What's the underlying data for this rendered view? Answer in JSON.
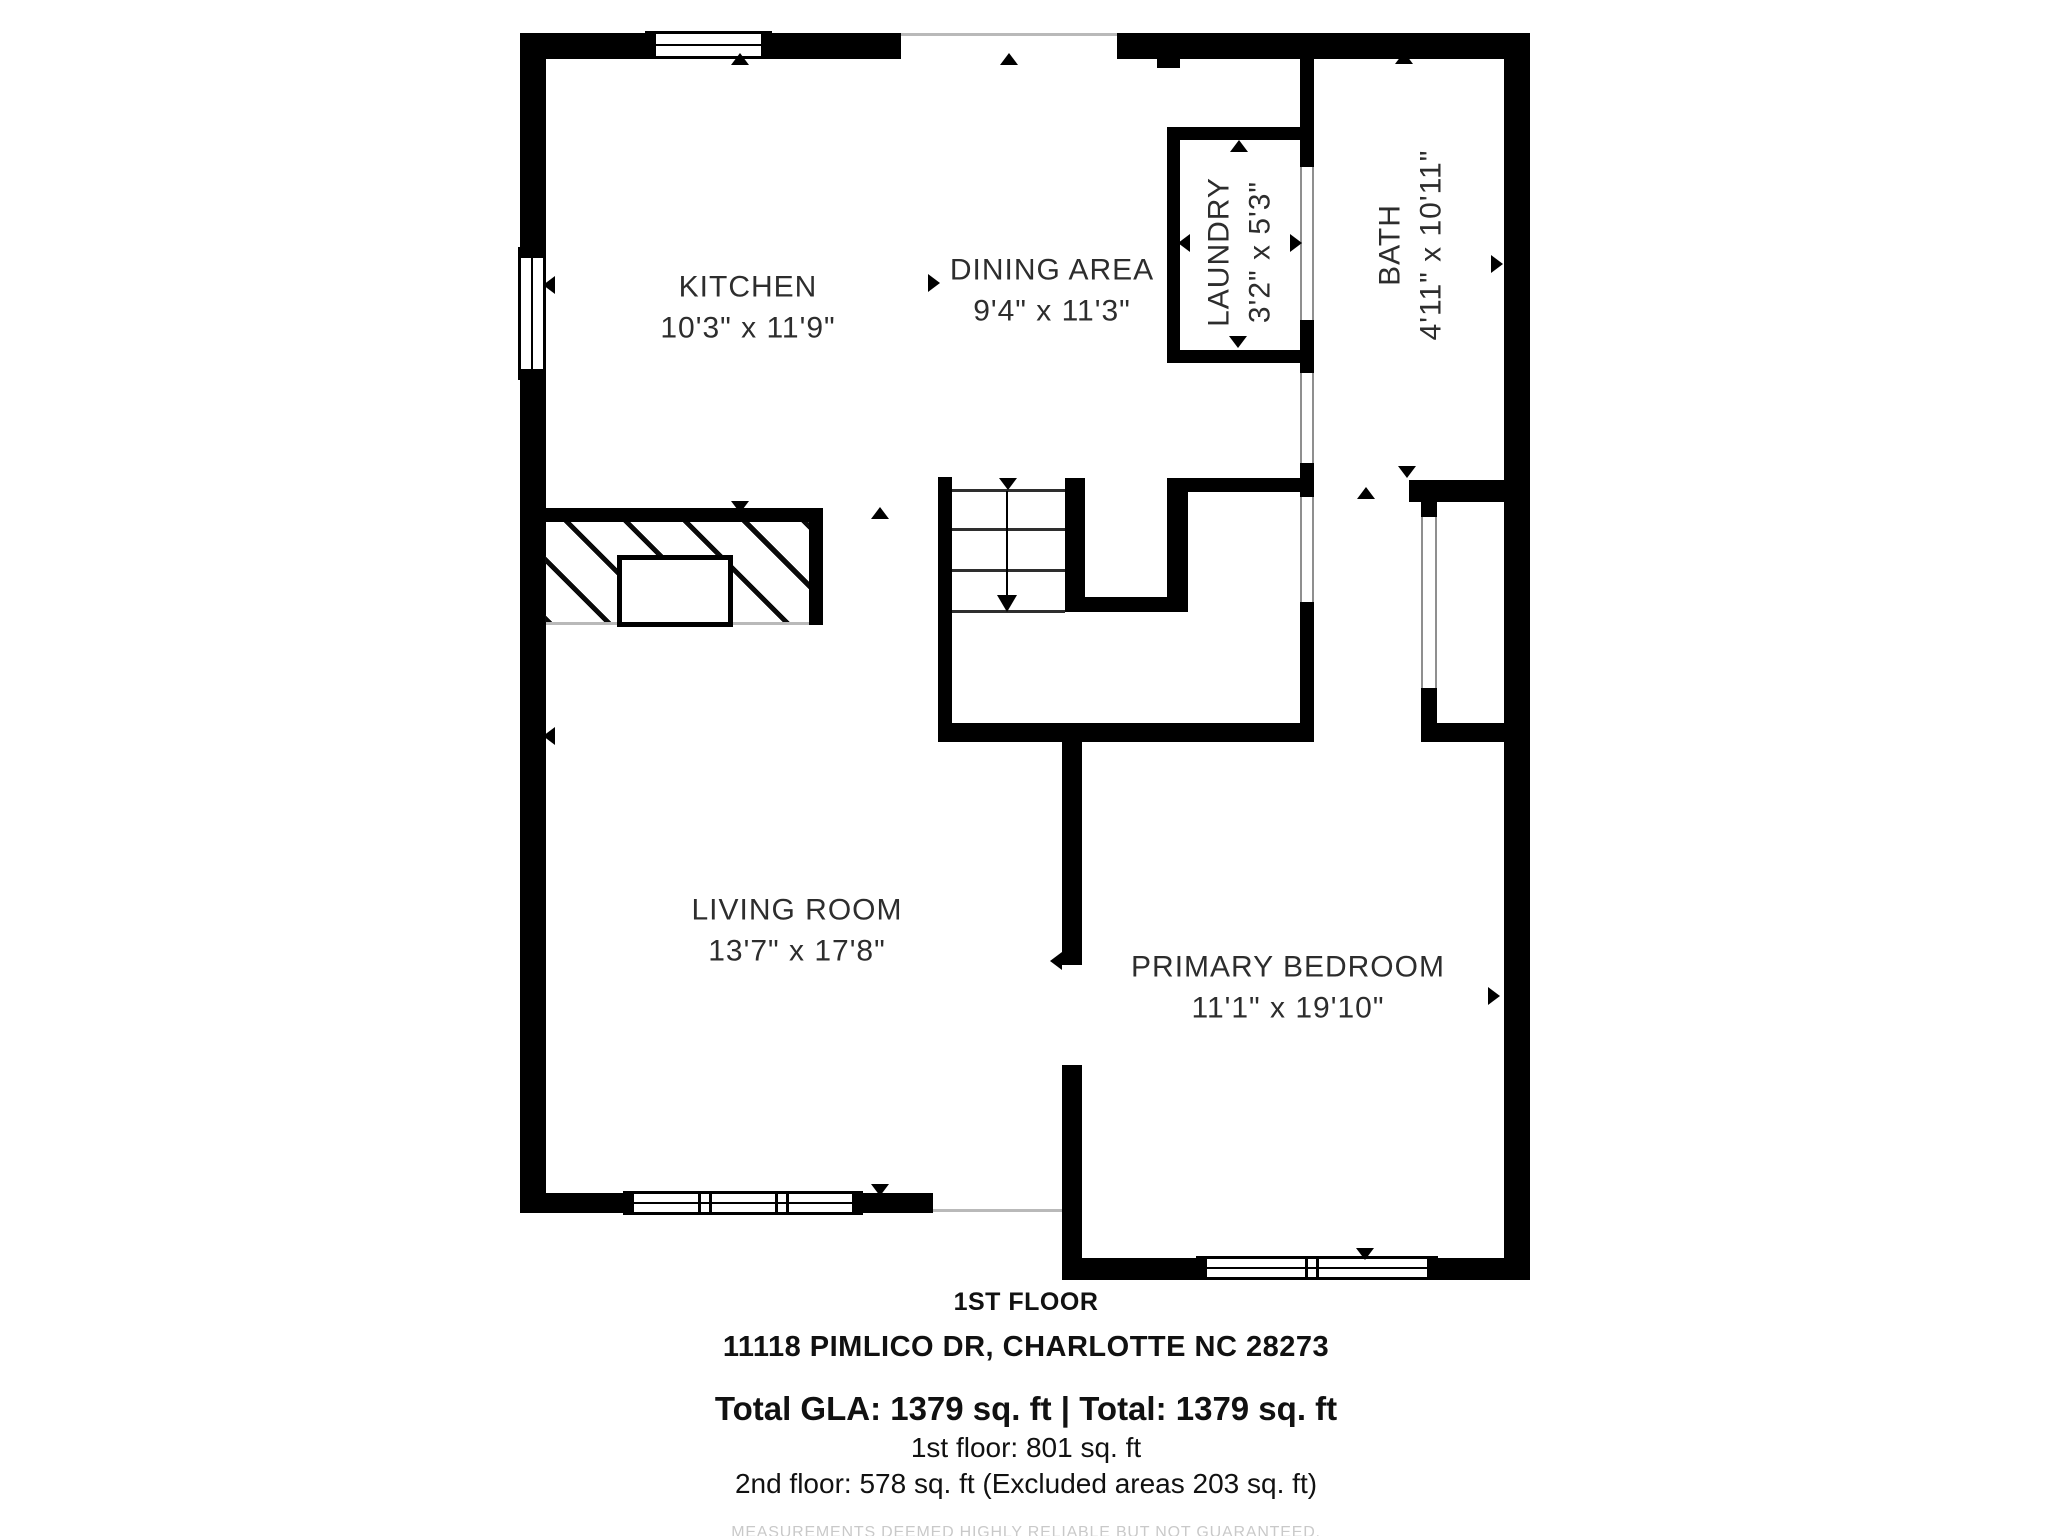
{
  "title": "1st floor plan - 11118 Pimlico Dr",
  "colors": {
    "wall": "#000000",
    "open_line": "#b9b9b9",
    "label_text": "#2d2d2d",
    "disclaimer_text": "#c9c9c9",
    "background": "#ffffff"
  },
  "rooms": [
    {
      "id": "kitchen",
      "name": "KITCHEN",
      "dims": "10'3\" x 11'9\"",
      "cx": 748,
      "cy": 308,
      "rotated": false
    },
    {
      "id": "dining-area",
      "name": "DINING AREA",
      "dims": "9'4\" x 11'3\"",
      "cx": 1052,
      "cy": 291,
      "rotated": false
    },
    {
      "id": "laundry",
      "name": "LAUNDRY",
      "dims": "3'2\" x 5'3\"",
      "cx": 1240,
      "cy": 252,
      "rotated": true
    },
    {
      "id": "bath",
      "name": "BATH",
      "dims": "4'11\" x 10'11\"",
      "cx": 1411,
      "cy": 245,
      "rotated": true
    },
    {
      "id": "living-room",
      "name": "LIVING ROOM",
      "dims": "13'7\" x 17'8\"",
      "cx": 797,
      "cy": 931,
      "rotated": false
    },
    {
      "id": "primary-bedroom",
      "name": "PRIMARY BEDROOM",
      "dims": "11'1\" x 19'10\"",
      "cx": 1288,
      "cy": 988,
      "rotated": false
    }
  ],
  "footer": {
    "floor_label": "1ST FLOOR",
    "address": "11118 PIMLICO DR, CHARLOTTE NC 28273",
    "total_line": "Total GLA: 1379 sq. ft | Total: 1379 sq. ft",
    "first_floor_line": "1st floor: 801 sq. ft",
    "second_floor_line": "2nd floor: 578 sq. ft (Excluded areas 203 sq. ft)",
    "disclaimer": "MEASUREMENTS DEEMED HIGHLY RELIABLE BUT NOT GUARANTEED."
  },
  "plan": {
    "walls": [
      {
        "n": "top-wall-left",
        "x": 520,
        "y": 33,
        "w": 125,
        "h": 26
      },
      {
        "n": "top-wall-mid",
        "x": 772,
        "y": 33,
        "w": 129,
        "h": 26
      },
      {
        "n": "top-wall-right",
        "x": 1117,
        "y": 33,
        "w": 413,
        "h": 26
      },
      {
        "n": "left-wall-upper",
        "x": 520,
        "y": 33,
        "w": 26,
        "h": 214
      },
      {
        "n": "left-wall-lower",
        "x": 520,
        "y": 375,
        "w": 26,
        "h": 838
      },
      {
        "n": "right-wall",
        "x": 1504,
        "y": 33,
        "w": 26,
        "h": 1247
      },
      {
        "n": "living-bottom-wall-left",
        "x": 520,
        "y": 1193,
        "w": 103,
        "h": 20
      },
      {
        "n": "living-bottom-wall-right",
        "x": 863,
        "y": 1193,
        "w": 70,
        "h": 20
      },
      {
        "n": "bedroom-left-wall-upper",
        "x": 1062,
        "y": 742,
        "w": 20,
        "h": 223
      },
      {
        "n": "bedroom-left-wall-lower",
        "x": 1062,
        "y": 1065,
        "w": 20,
        "h": 215
      },
      {
        "n": "bedroom-bottom-wall-left",
        "x": 1082,
        "y": 1258,
        "w": 114,
        "h": 22
      },
      {
        "n": "bedroom-bottom-wall-right",
        "x": 1438,
        "y": 1258,
        "w": 66,
        "h": 22
      },
      {
        "n": "fireplace-wall",
        "x": 545,
        "y": 508,
        "w": 278,
        "h": 14
      },
      {
        "n": "fireplace-right-wall",
        "x": 809,
        "y": 522,
        "w": 14,
        "h": 103
      },
      {
        "n": "stairwell-left-wall",
        "x": 938,
        "y": 477,
        "w": 14,
        "h": 265
      },
      {
        "n": "stair-closet-left-wall",
        "x": 1065,
        "y": 478,
        "w": 20,
        "h": 134
      },
      {
        "n": "stair-closet-right-wall",
        "x": 1167,
        "y": 478,
        "w": 21,
        "h": 134
      },
      {
        "n": "stair-closet-bottom-wall",
        "x": 1065,
        "y": 597,
        "w": 123,
        "h": 15
      },
      {
        "n": "hall-bottom-wall",
        "x": 938,
        "y": 723,
        "w": 376,
        "h": 19
      },
      {
        "n": "bedroom-top-wall-right",
        "x": 1421,
        "y": 723,
        "w": 83,
        "h": 19
      },
      {
        "n": "laundry-top-wall",
        "x": 1167,
        "y": 127,
        "w": 146,
        "h": 13
      },
      {
        "n": "laundry-bottom-wall",
        "x": 1167,
        "y": 350,
        "w": 146,
        "h": 13
      },
      {
        "n": "laundry-left-wall",
        "x": 1167,
        "y": 127,
        "w": 13,
        "h": 236
      },
      {
        "n": "bath-left-wall-upper",
        "x": 1300,
        "y": 59,
        "w": 14,
        "h": 108
      },
      {
        "n": "bath-left-wall-mid",
        "x": 1300,
        "y": 320,
        "w": 14,
        "h": 53
      },
      {
        "n": "hall-divider-nub",
        "x": 1300,
        "y": 463,
        "w": 14,
        "h": 34
      },
      {
        "n": "hall-divider-lower",
        "x": 1300,
        "y": 602,
        "w": 14,
        "h": 121
      },
      {
        "n": "bath-bottom-wall",
        "x": 1167,
        "y": 478,
        "w": 133,
        "h": 14
      },
      {
        "n": "closet-top-wall",
        "x": 1409,
        "y": 480,
        "w": 95,
        "h": 22
      },
      {
        "n": "closet-door-top-cap",
        "x": 1421,
        "y": 480,
        "w": 16,
        "h": 37
      },
      {
        "n": "closet-door-bottom-cap",
        "x": 1421,
        "y": 688,
        "w": 16,
        "h": 35
      },
      {
        "n": "top-wall-stub",
        "x": 1157,
        "y": 59,
        "w": 23,
        "h": 9
      }
    ],
    "open_lines": [
      {
        "n": "top-opening-line",
        "x": 901,
        "y": 33,
        "w": 216,
        "h": 3
      },
      {
        "n": "living-bedroom-line",
        "x": 933,
        "y": 1209,
        "w": 129,
        "h": 3
      },
      {
        "n": "fireplace-bottom-line",
        "x": 545,
        "y": 622,
        "w": 264,
        "h": 3
      }
    ],
    "windows": [
      {
        "n": "kitchen-top-window",
        "x": 645,
        "y": 31,
        "w": 127,
        "h": 28,
        "o": "h",
        "mullions": []
      },
      {
        "n": "kitchen-left-window",
        "x": 518,
        "y": 247,
        "w": 28,
        "h": 133,
        "o": "v",
        "mullions": []
      },
      {
        "n": "living-bottom-window",
        "x": 623,
        "y": 1191,
        "w": 240,
        "h": 24,
        "o": "h",
        "mullions": [
          80,
          157
        ]
      },
      {
        "n": "bedroom-bottom-window",
        "x": 1196,
        "y": 1256,
        "w": 242,
        "h": 24,
        "o": "h",
        "mullions": [
          114
        ]
      }
    ],
    "door_strips": [
      {
        "n": "laundry-bath-door",
        "x": 1300,
        "y": 167,
        "w": 14,
        "h": 153
      },
      {
        "n": "hall-opening-upper",
        "x": 1300,
        "y": 373,
        "w": 14,
        "h": 90
      },
      {
        "n": "hall-opening-lower",
        "x": 1300,
        "y": 497,
        "w": 14,
        "h": 105
      },
      {
        "n": "bedroom-closet-door",
        "x": 1421,
        "y": 517,
        "w": 16,
        "h": 171
      }
    ],
    "stairs": {
      "treads_x": 952,
      "treads_w": 113,
      "tread_ys": [
        489,
        528,
        569,
        610
      ],
      "stem_x": 1007,
      "stem_y1": 491,
      "stem_y2": 595,
      "head": {
        "cx": 1007,
        "y": 595,
        "hw": 10,
        "hh": 17
      }
    },
    "fireplace": {
      "hatch": {
        "x": 545,
        "y": 522,
        "w": 264,
        "h": 100
      },
      "hearth": {
        "x": 617,
        "y": 555,
        "w": 116,
        "h": 72
      }
    },
    "markers": [
      {
        "n": "entry-marker",
        "cx": 740,
        "cy": 59,
        "dir": "up"
      },
      {
        "n": "entry-marker",
        "cx": 1009,
        "cy": 59,
        "dir": "up"
      },
      {
        "n": "window-marker",
        "cx": 549,
        "cy": 285,
        "dir": "left"
      },
      {
        "n": "fireplace-marker",
        "cx": 740,
        "cy": 507,
        "dir": "down"
      },
      {
        "n": "passage-marker",
        "cx": 880,
        "cy": 513,
        "dir": "up"
      },
      {
        "n": "stairs-top-marker",
        "cx": 1008,
        "cy": 484,
        "dir": "down"
      },
      {
        "n": "laundry-marker-top",
        "cx": 1239,
        "cy": 146,
        "dir": "up"
      },
      {
        "n": "laundry-marker-bottom",
        "cx": 1238,
        "cy": 342,
        "dir": "down"
      },
      {
        "n": "laundry-marker-left",
        "cx": 1184,
        "cy": 243,
        "dir": "left"
      },
      {
        "n": "laundry-marker-right",
        "cx": 1296,
        "cy": 243,
        "dir": "right"
      },
      {
        "n": "bath-marker-top",
        "cx": 1404,
        "cy": 58,
        "dir": "up"
      },
      {
        "n": "bath-marker-right",
        "cx": 1497,
        "cy": 264,
        "dir": "right"
      },
      {
        "n": "bath-door-marker",
        "cx": 1407,
        "cy": 472,
        "dir": "down"
      },
      {
        "n": "hall-marker",
        "cx": 1366,
        "cy": 493,
        "dir": "up"
      },
      {
        "n": "dining-marker",
        "cx": 934,
        "cy": 283,
        "dir": "right"
      },
      {
        "n": "bedroom-door-marker",
        "cx": 1056,
        "cy": 961,
        "dir": "left"
      },
      {
        "n": "bedroom-marker-right",
        "cx": 1494,
        "cy": 996,
        "dir": "right"
      },
      {
        "n": "living-marker-left",
        "cx": 549,
        "cy": 736,
        "dir": "left"
      },
      {
        "n": "living-window-marker",
        "cx": 880,
        "cy": 1190,
        "dir": "down"
      },
      {
        "n": "bedroom-window-marker",
        "cx": 1365,
        "cy": 1254,
        "dir": "down"
      }
    ]
  }
}
